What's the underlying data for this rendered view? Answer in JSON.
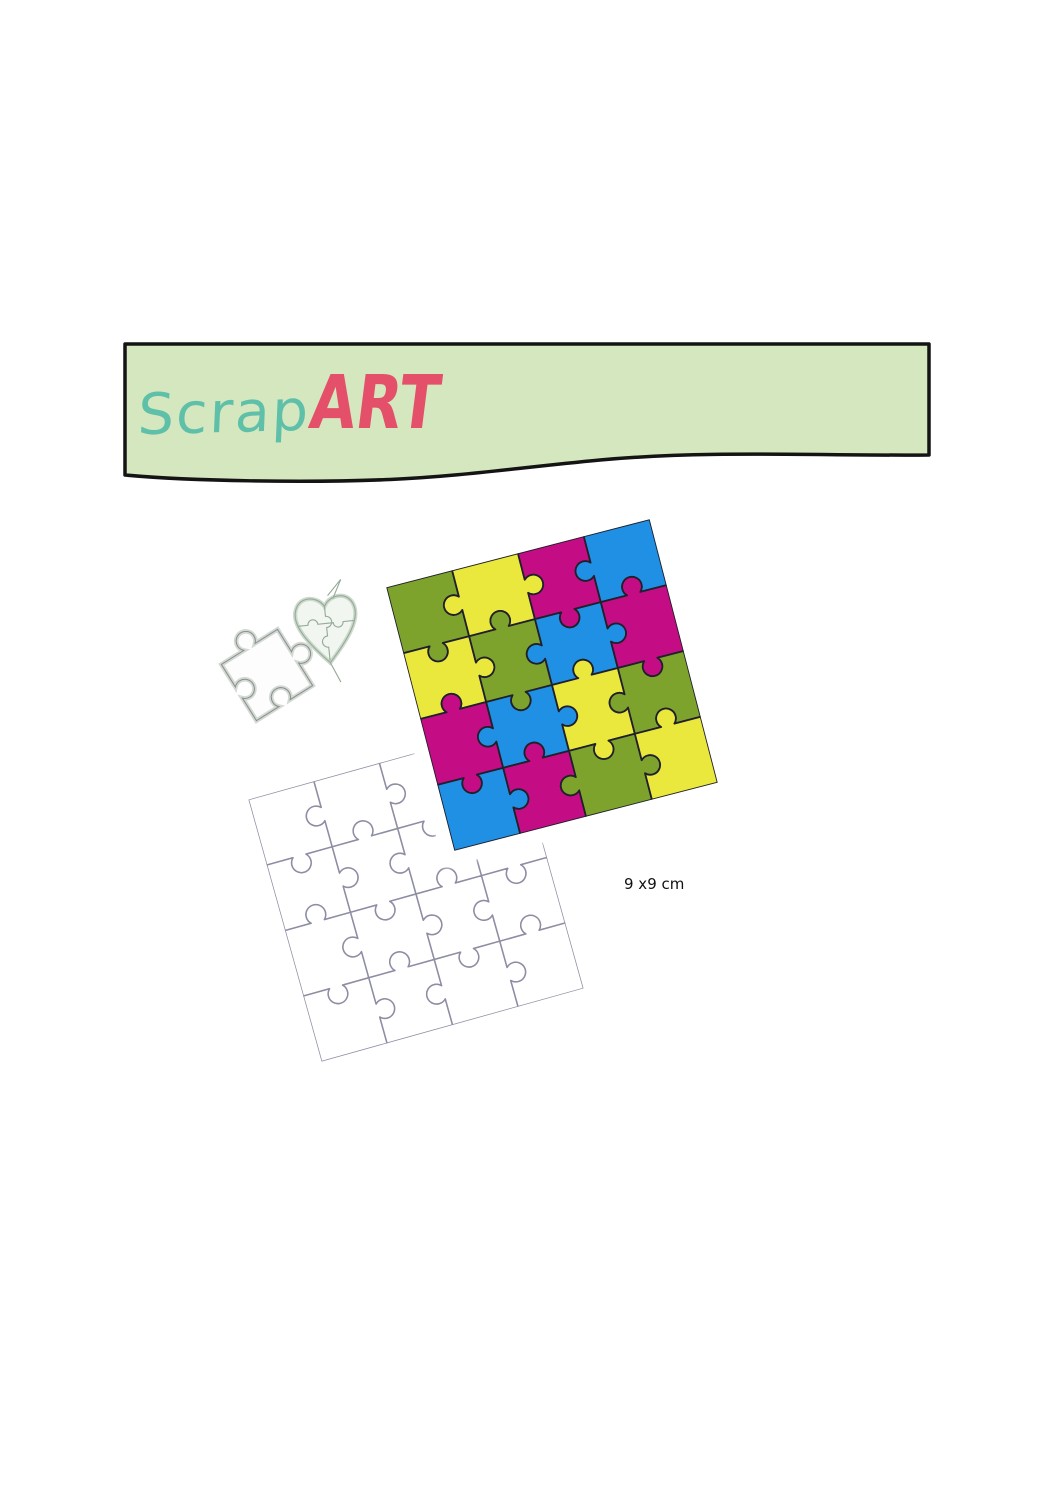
{
  "banner": {
    "brand_scrap": "Scrap",
    "brand_art": "ART",
    "background": "#d5e7be",
    "border_color": "#141414",
    "scrap_color": "#5fc0a9",
    "art_color": "#e4506a"
  },
  "product": {
    "dimension_label": "9 x9 cm",
    "colored_puzzle": {
      "rows": 4,
      "cols": 4,
      "rotation_deg": -14.5,
      "palette": {
        "green": "#7ea32c",
        "yellow": "#ebe83d",
        "magenta": "#c40d85",
        "blue": "#2090e4"
      },
      "outline_color": "#20202c",
      "grid": [
        [
          "green",
          "yellow",
          "magenta",
          "blue"
        ],
        [
          "yellow",
          "green",
          "blue",
          "magenta"
        ],
        [
          "magenta",
          "blue",
          "yellow",
          "green"
        ],
        [
          "blue",
          "magenta",
          "green",
          "yellow"
        ]
      ]
    },
    "die_template": {
      "rows": 4,
      "cols": 4,
      "rotation_deg": -15.6,
      "stroke": "#8d8da4",
      "fill": "#ffffff"
    },
    "heart_die": {
      "stroke": "#96ab99",
      "rim": "#ccd9cc",
      "fill": "#f2f6f1"
    },
    "piece_die": {
      "stroke": "#8b918e",
      "rim": "#d4d9d4",
      "fill": "#fdfdfd"
    }
  }
}
